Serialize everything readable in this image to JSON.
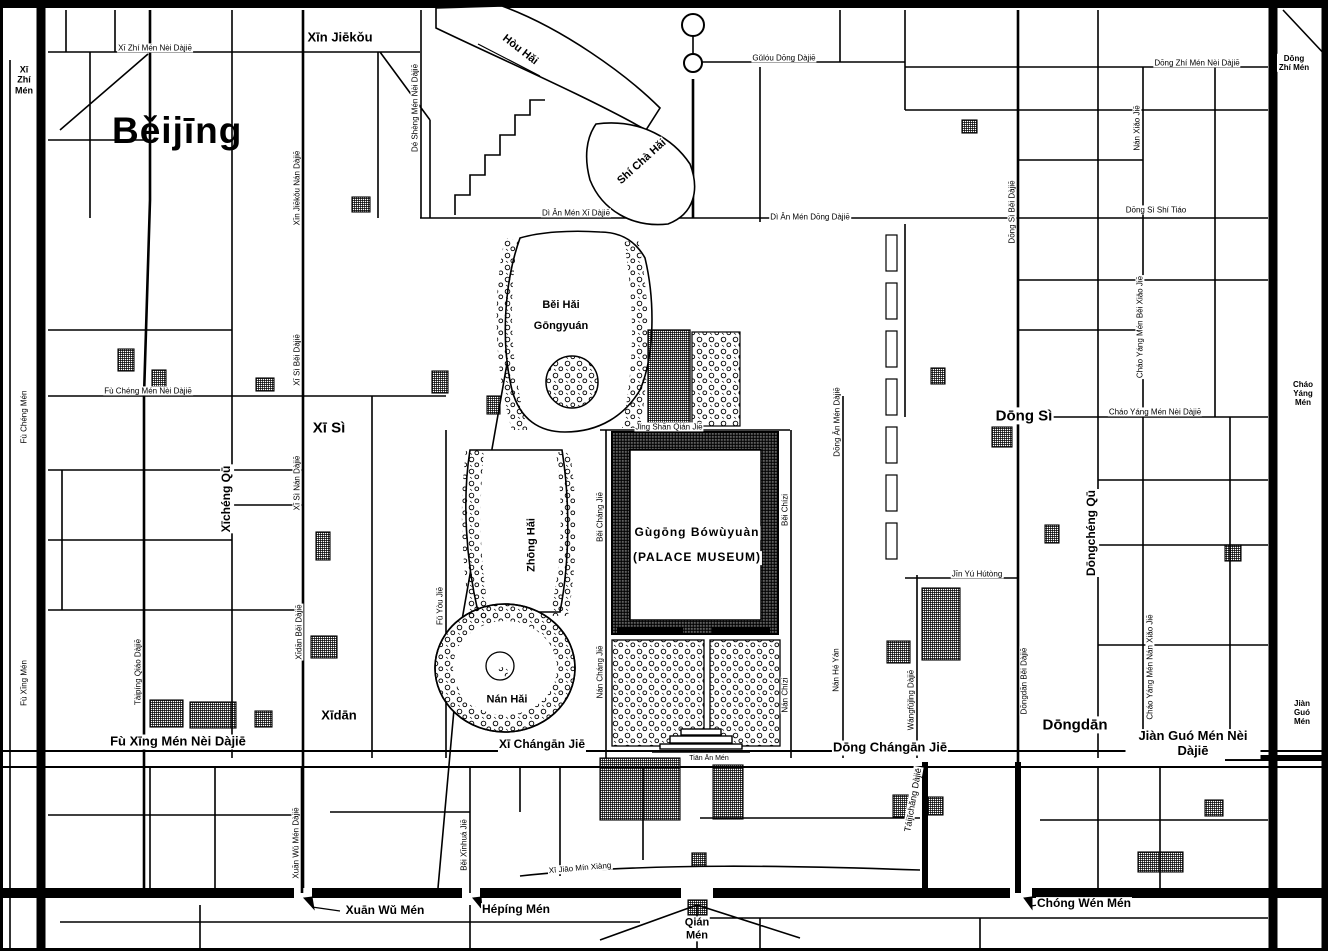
{
  "map": {
    "title": "Běijīng",
    "colors": {
      "ink": "#000000",
      "paper": "#ffffff"
    },
    "legend": {
      "palace_name": "Gùgōng Bówùyuàn",
      "palace_name_en": "(PALACE MUSEUM)"
    },
    "labels": [
      {
        "id": "xi-zhi-men-nei-dajie",
        "t": "Xī Zhí Mén Nèi Dàjiē",
        "x": 155,
        "y": 48,
        "r": 0,
        "s": 8
      },
      {
        "id": "xi-zhi-men",
        "t": "Xī\nZhí\nMén",
        "x": 24,
        "y": 80,
        "r": 0,
        "s": 9,
        "w": 700
      },
      {
        "id": "xin-jiekou",
        "t": "Xīn Jiēkǒu",
        "x": 340,
        "y": 38,
        "r": 0,
        "s": 13,
        "w": 700
      },
      {
        "id": "de-sheng-men-nei-dajie",
        "t": "Dé Shèng Mén Nèi Dàjiē",
        "x": 415,
        "y": 108,
        "r": -90,
        "s": 8
      },
      {
        "id": "xin-jiekou-nan-dajie",
        "t": "Xīn Jiēkǒu Nán Dàjiē",
        "x": 297,
        "y": 188,
        "r": -90,
        "s": 8
      },
      {
        "id": "hou-hai",
        "t": "Hòu Hǎi",
        "x": 520,
        "y": 50,
        "r": 38,
        "s": 11,
        "w": 700
      },
      {
        "id": "shi-cha-hai",
        "t": "Shí Chà Hǎi",
        "x": 642,
        "y": 162,
        "r": -42,
        "s": 11,
        "w": 700
      },
      {
        "id": "gulou-dong-dajie",
        "t": "Gǔlóu Dōng Dàjiē",
        "x": 784,
        "y": 58,
        "r": 0,
        "s": 8
      },
      {
        "id": "dong-zhi-men-nei-dajie",
        "t": "Dōng Zhí Mén Nèi Dàjiē",
        "x": 1197,
        "y": 63,
        "r": 0,
        "s": 8
      },
      {
        "id": "dong-zhi-men",
        "t": "Dōng Zhí Mén",
        "x": 1294,
        "y": 63,
        "r": 0,
        "s": 8,
        "w": 700
      },
      {
        "id": "nan-xiao-jie",
        "t": "Nán Xiǎo Jiē",
        "x": 1137,
        "y": 128,
        "r": -90,
        "s": 8
      },
      {
        "id": "dong-si-bei-dajie",
        "t": "Dōng Sì Běi Dàjiē",
        "x": 1012,
        "y": 212,
        "r": -90,
        "s": 8
      },
      {
        "id": "dong-si-shi-tiao",
        "t": "Dōng Sì Shí Tiáo",
        "x": 1156,
        "y": 210,
        "r": 0,
        "s": 8
      },
      {
        "id": "di-an-men-xi-dajie",
        "t": "Dì Ān Mén Xī Dàjiē",
        "x": 576,
        "y": 213,
        "r": 0,
        "s": 8
      },
      {
        "id": "di-an-men-dong-dajie",
        "t": "Dì Ān Mén Dōng Dàjiē",
        "x": 810,
        "y": 217,
        "r": 0,
        "s": 8
      },
      {
        "id": "bei-hai-gongyuan",
        "t": "Běi Hǎi\nGōngyuán",
        "x": 561,
        "y": 316,
        "r": 0,
        "s": 11,
        "w": 700,
        "lh": 1.9
      },
      {
        "id": "fu-cheng-men-nei-dajie",
        "t": "Fù Chéng Mén Nèi Dàjiē",
        "x": 148,
        "y": 391,
        "r": 0,
        "s": 8
      },
      {
        "id": "fu-cheng-men",
        "t": "Fù Chéng Mén",
        "x": 24,
        "y": 417,
        "r": -90,
        "s": 8
      },
      {
        "id": "xi-si-bei-dajie",
        "t": "Xī Sì Běi Dàjiē",
        "x": 297,
        "y": 360,
        "r": -90,
        "s": 8
      },
      {
        "id": "xi-si",
        "t": "Xī Sì",
        "x": 329,
        "y": 428,
        "r": 0,
        "s": 15,
        "w": 700
      },
      {
        "id": "dong-si",
        "t": "Dōng Sì",
        "x": 1024,
        "y": 416,
        "r": 0,
        "s": 15,
        "w": 700
      },
      {
        "id": "chao-yang-men-nei-dajie",
        "t": "Cháo Yáng Mén Nèi Dàjiē",
        "x": 1155,
        "y": 412,
        "r": 0,
        "s": 8
      },
      {
        "id": "chao-yang-men",
        "t": "Cháo\nYáng\nMén",
        "x": 1303,
        "y": 394,
        "r": 0,
        "s": 8,
        "w": 700
      },
      {
        "id": "chao-yang-men-bei-xiao-jie",
        "t": "Cháo Yáng Mén Běi Xiǎo Jiē",
        "x": 1140,
        "y": 327,
        "r": -90,
        "s": 8
      },
      {
        "id": "xicheng-qu",
        "t": "Xīchéng Qū",
        "x": 227,
        "y": 499,
        "r": -90,
        "s": 12,
        "w": 700
      },
      {
        "id": "dongcheng-qu",
        "t": "Dōngchéng Qū",
        "x": 1092,
        "y": 533,
        "r": -90,
        "s": 12,
        "w": 700
      },
      {
        "id": "xi-si-nan-dajie",
        "t": "Xī Sì Nán Dàjiē",
        "x": 297,
        "y": 483,
        "r": -90,
        "s": 8
      },
      {
        "id": "jing-shan-qian-jie",
        "t": "Jǐng Shān Qián Jiē",
        "x": 669,
        "y": 427,
        "r": 0,
        "s": 8
      },
      {
        "id": "bei-chang-jie",
        "t": "Běi Cháng Jiē",
        "x": 600,
        "y": 517,
        "r": -90,
        "s": 8
      },
      {
        "id": "nan-chang-jie",
        "t": "Nán Cháng Jiē",
        "x": 600,
        "y": 672,
        "r": -90,
        "s": 8
      },
      {
        "id": "zhong-hai",
        "t": "Zhōng Hǎi",
        "x": 532,
        "y": 545,
        "r": -90,
        "s": 11,
        "w": 700
      },
      {
        "id": "nan-hai",
        "t": "Nán Hǎi",
        "x": 507,
        "y": 700,
        "r": 0,
        "s": 11,
        "w": 700
      },
      {
        "id": "fu-you-jie",
        "t": "Fǔ Yòu Jiē",
        "x": 440,
        "y": 606,
        "r": -90,
        "s": 8
      },
      {
        "id": "gugong-bowuyuan",
        "t": "Gùgōng Bówùyuàn",
        "x": 697,
        "y": 533,
        "r": 0,
        "s": 12,
        "w": 700,
        "ls": 1
      },
      {
        "id": "palace-museum",
        "t": "(PALACE MUSEUM)",
        "x": 697,
        "y": 558,
        "r": 0,
        "s": 12,
        "w": 700,
        "ls": 1
      },
      {
        "id": "bei-chizi",
        "t": "Běi Chízi",
        "x": 785,
        "y": 510,
        "r": -90,
        "s": 8
      },
      {
        "id": "nan-chizi",
        "t": "Nán Chízi",
        "x": 785,
        "y": 695,
        "r": -90,
        "s": 8
      },
      {
        "id": "dong-an-men-dajie",
        "t": "Dōng Ān Mén Dàjiē",
        "x": 837,
        "y": 422,
        "r": -90,
        "s": 8
      },
      {
        "id": "nan-he-yan",
        "t": "Nán Hé Yán",
        "x": 836,
        "y": 670,
        "r": -90,
        "s": 8
      },
      {
        "id": "jin-yu-hutong",
        "t": "Jīn Yú Hútòng",
        "x": 977,
        "y": 574,
        "r": 0,
        "s": 8
      },
      {
        "id": "wangfujing-dajie",
        "t": "Wángfǔjǐng Dàjiē",
        "x": 911,
        "y": 700,
        "r": -90,
        "s": 8
      },
      {
        "id": "dongdan-bei-dajie",
        "t": "Dōngdān Běi Dàjiē",
        "x": 1024,
        "y": 681,
        "r": -90,
        "s": 8
      },
      {
        "id": "chao-yang-men-nan-xiao-jie",
        "t": "Cháo Yáng Mén Nán Xiǎo Jiē",
        "x": 1150,
        "y": 667,
        "r": -90,
        "s": 8
      },
      {
        "id": "taiping-qiao-dajie",
        "t": "Tàipíng Qiáo Dàjiē",
        "x": 138,
        "y": 672,
        "r": -90,
        "s": 8
      },
      {
        "id": "xidan-bei-dajie",
        "t": "Xīdān Běi Dàjiē",
        "x": 299,
        "y": 632,
        "r": -90,
        "s": 8
      },
      {
        "id": "xidan",
        "t": "Xīdān",
        "x": 339,
        "y": 716,
        "r": 0,
        "s": 13,
        "w": 700
      },
      {
        "id": "dongdan",
        "t": "Dōngdān",
        "x": 1075,
        "y": 725,
        "r": 0,
        "s": 15,
        "w": 700
      },
      {
        "id": "fu-xing-men",
        "t": "Fù Xīng Mén",
        "x": 24,
        "y": 683,
        "r": -90,
        "s": 8
      },
      {
        "id": "fu-xing-men-nei-dajie",
        "t": "Fù Xīng Mén Nèi Dàjiē",
        "x": 178,
        "y": 742,
        "r": 0,
        "s": 13,
        "w": 700
      },
      {
        "id": "xi-changan-jie",
        "t": "Xī Chángān Jiē",
        "x": 542,
        "y": 745,
        "r": 0,
        "s": 12,
        "w": 700
      },
      {
        "id": "dong-changan-jie",
        "t": "Dōng Chángān Jiē",
        "x": 890,
        "y": 748,
        "r": 0,
        "s": 13,
        "w": 700
      },
      {
        "id": "jian-guo-men-nei-dajie",
        "t": "Jiàn Guó Mén Nèi Dàjiē",
        "x": 1193,
        "y": 744,
        "r": 0,
        "s": 13,
        "w": 700
      },
      {
        "id": "tian-an-men",
        "t": "Tiān Ān Mén",
        "x": 709,
        "y": 759,
        "r": 0,
        "s": 7
      },
      {
        "id": "jian-guo-men",
        "t": "Jiàn\nGuó\nMén",
        "x": 1302,
        "y": 713,
        "r": 0,
        "s": 8,
        "w": 700
      },
      {
        "id": "taijichang-dajie",
        "t": "Táijīchǎng Dàjiē",
        "x": 913,
        "y": 800,
        "r": -80,
        "s": 9
      },
      {
        "id": "xi-jiao-min-xiang",
        "t": "Xī Jiāo Mín Xiàng",
        "x": 580,
        "y": 868,
        "r": -5,
        "s": 8
      },
      {
        "id": "xuan-wu-men-dajie",
        "t": "Xuān Wǔ Mén Dàjiē",
        "x": 296,
        "y": 843,
        "r": -90,
        "s": 8
      },
      {
        "id": "bei-xinhua-jie",
        "t": "Běi Xīnhuá Jiē",
        "x": 464,
        "y": 845,
        "r": -90,
        "s": 8
      },
      {
        "id": "xuan-wu-men",
        "t": "Xuān Wǔ Mén",
        "x": 385,
        "y": 911,
        "r": 0,
        "s": 12,
        "w": 700
      },
      {
        "id": "heping-men",
        "t": "Hépíng Mén",
        "x": 516,
        "y": 910,
        "r": 0,
        "s": 12,
        "w": 700
      },
      {
        "id": "qian-men",
        "t": "Qián\nMén",
        "x": 697,
        "y": 929,
        "r": 0,
        "s": 11,
        "w": 700
      },
      {
        "id": "chong-wen-men",
        "t": "Chóng Wén Mén",
        "x": 1084,
        "y": 904,
        "r": 0,
        "s": 12,
        "w": 700
      }
    ]
  }
}
